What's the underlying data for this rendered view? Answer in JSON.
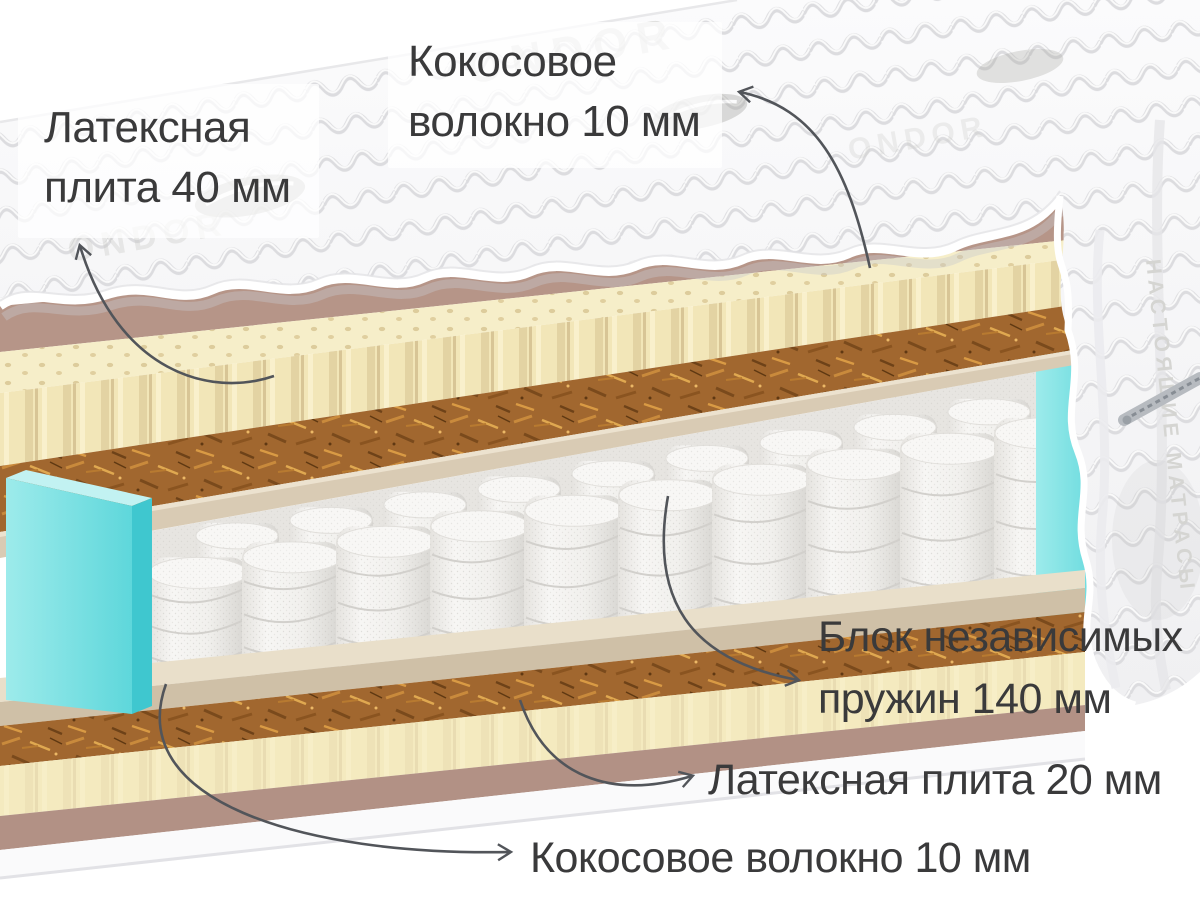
{
  "page": {
    "background": "#ffffff"
  },
  "diagram": {
    "type": "mattress-cutaway",
    "labels": {
      "latex_top": {
        "line1": "Латексная",
        "line2": "плита 40 мм"
      },
      "coconut_top": {
        "line1": "Кокосовое",
        "line2": "волокно 10 мм"
      },
      "spring_block": {
        "line1": "Блок независимых",
        "line2": "пружин 140 мм"
      },
      "latex_bottom": {
        "text": "Латексная плита 20 мм"
      },
      "coconut_bottom": {
        "text": "Кокосовое волокно 10 мм"
      }
    },
    "cover": {
      "watermark": "ONDOR",
      "side_text": "НАСТОЯЩИЕ МАТРАСЫ"
    },
    "colors": {
      "latex": "#f3e6b8",
      "coconut": "#a1662c",
      "felt": "#b69588",
      "board": "#d9cbb4",
      "spring_fabric": "#f2f1ee",
      "side_foam": "#74dede",
      "cover": "#f6f6f7",
      "label_text": "#3a3a3b",
      "arrow": "#52555a"
    }
  }
}
